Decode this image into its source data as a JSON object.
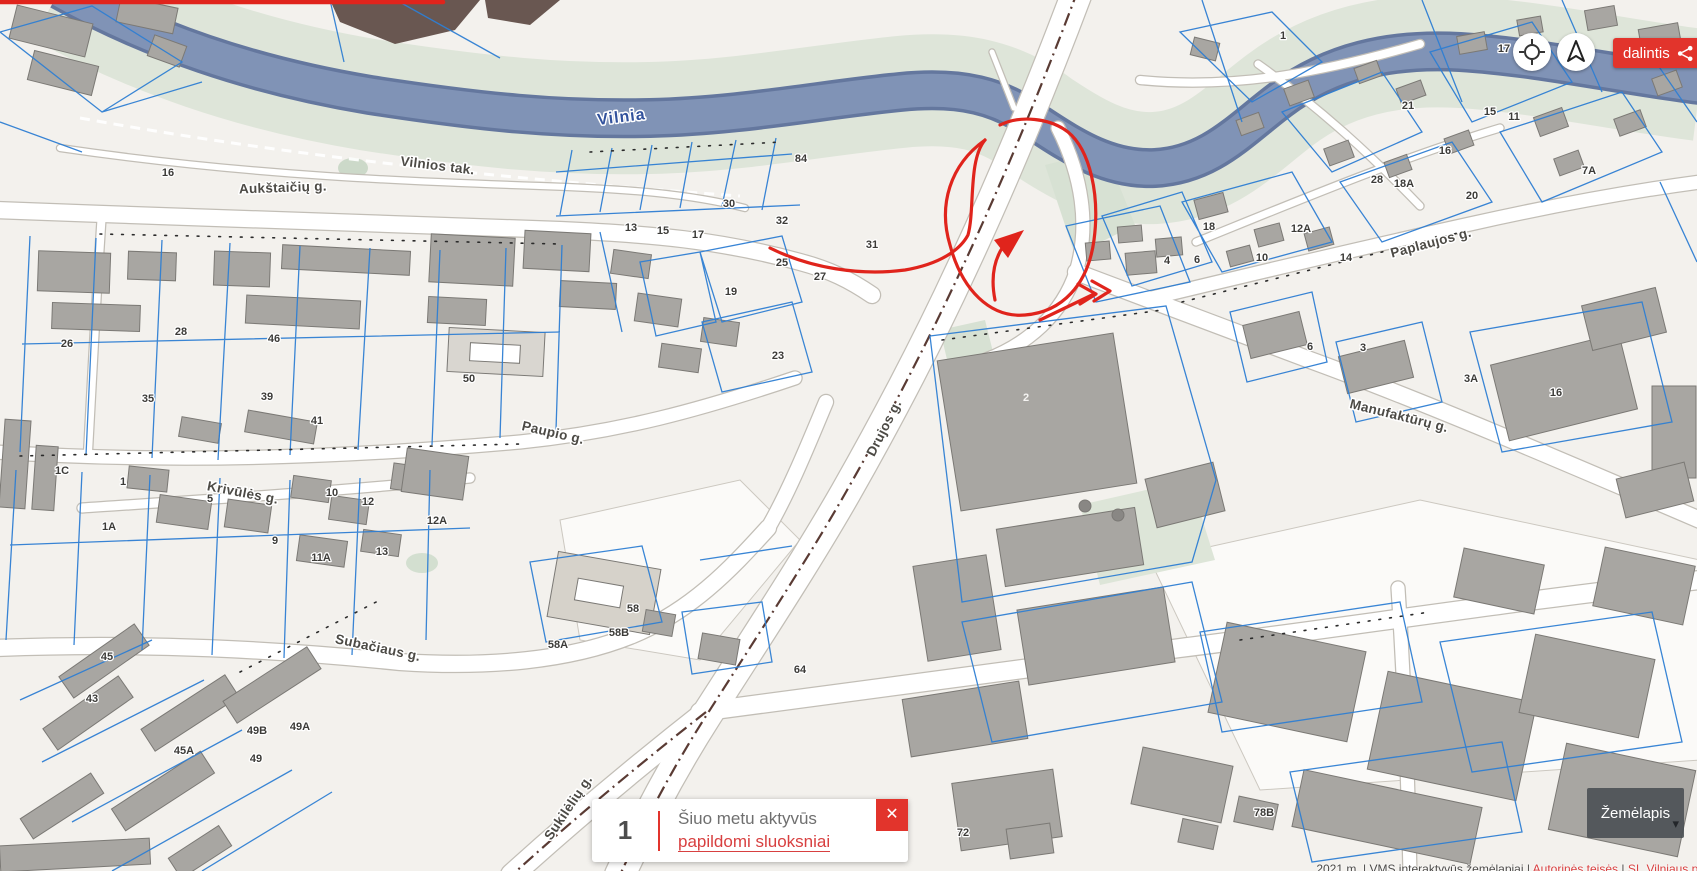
{
  "icons": {
    "close": "✕",
    "caret": "▾"
  },
  "controls": {
    "share_label": "dalintis"
  },
  "notification": {
    "count": "1",
    "message": "Šiuo metu aktyvūs",
    "link_label": "papildomi sluoksniai"
  },
  "basemap": {
    "label": "Žemėlapis"
  },
  "attribution": {
    "prefix": "2021 m. | VMS interaktyvūs žemėlapiai | ",
    "copyright_link": "Autorinės teisės",
    "separator": " | ",
    "publisher": "SĮ „Vilniaus planas“"
  },
  "colors": {
    "accent_red": "#e2342c",
    "link_red": "#d84040",
    "annotation_red": "#e0241c",
    "parcel_blue": "#2e7ed3",
    "river_blue": "#8093b6",
    "building_gray": "#a8a6a2",
    "basemap_bg": "rgba(72,77,82,0.88)"
  },
  "map": {
    "river_label": {
      "text": "Vilnia",
      "x": 622,
      "y": 122,
      "rotate": -7
    },
    "street_labels": [
      {
        "text": "Vilnios tak.",
        "x": 437,
        "y": 170,
        "rotate": 7
      },
      {
        "text": "Aukštaičių g.",
        "x": 283,
        "y": 192,
        "rotate": -2
      },
      {
        "text": "Paupio g.",
        "x": 552,
        "y": 437,
        "rotate": 13
      },
      {
        "text": "Krivūlės g.",
        "x": 242,
        "y": 497,
        "rotate": 11
      },
      {
        "text": "Subačiaus g.",
        "x": 377,
        "y": 652,
        "rotate": 12
      },
      {
        "text": "Drujos g.",
        "x": 888,
        "y": 430,
        "rotate": -63
      },
      {
        "text": "Paplaujos g.",
        "x": 1432,
        "y": 247,
        "rotate": -15
      },
      {
        "text": "Manufaktūrų g.",
        "x": 1398,
        "y": 420,
        "rotate": 14
      },
      {
        "text": "Sukilėlių g.",
        "x": 572,
        "y": 810,
        "rotate": -56
      }
    ],
    "parcel_numbers": [
      {
        "text": "16",
        "x": 168,
        "y": 176
      },
      {
        "text": "13",
        "x": 631,
        "y": 231
      },
      {
        "text": "15",
        "x": 663,
        "y": 234
      },
      {
        "text": "17",
        "x": 698,
        "y": 238
      },
      {
        "text": "30",
        "x": 729,
        "y": 207
      },
      {
        "text": "32",
        "x": 782,
        "y": 224
      },
      {
        "text": "84",
        "x": 801,
        "y": 162
      },
      {
        "text": "31",
        "x": 872,
        "y": 248
      },
      {
        "text": "25",
        "x": 782,
        "y": 266
      },
      {
        "text": "27",
        "x": 820,
        "y": 280
      },
      {
        "text": "19",
        "x": 731,
        "y": 295
      },
      {
        "text": "23",
        "x": 778,
        "y": 359
      },
      {
        "text": "50",
        "x": 469,
        "y": 382
      },
      {
        "text": "46",
        "x": 274,
        "y": 342
      },
      {
        "text": "28",
        "x": 181,
        "y": 335
      },
      {
        "text": "26",
        "x": 67,
        "y": 347
      },
      {
        "text": "35",
        "x": 148,
        "y": 402
      },
      {
        "text": "39",
        "x": 267,
        "y": 400
      },
      {
        "text": "41",
        "x": 317,
        "y": 424
      },
      {
        "text": "1C",
        "x": 62,
        "y": 474
      },
      {
        "text": "1",
        "x": 123,
        "y": 485
      },
      {
        "text": "1A",
        "x": 109,
        "y": 530
      },
      {
        "text": "5",
        "x": 210,
        "y": 502
      },
      {
        "text": "9",
        "x": 275,
        "y": 544
      },
      {
        "text": "10",
        "x": 332,
        "y": 496
      },
      {
        "text": "12",
        "x": 368,
        "y": 505
      },
      {
        "text": "12A",
        "x": 437,
        "y": 524
      },
      {
        "text": "11A",
        "x": 321,
        "y": 561
      },
      {
        "text": "13",
        "x": 382,
        "y": 555
      },
      {
        "text": "58",
        "x": 633,
        "y": 612
      },
      {
        "text": "58B",
        "x": 619,
        "y": 636
      },
      {
        "text": "58A",
        "x": 558,
        "y": 648
      },
      {
        "text": "64",
        "x": 800,
        "y": 673
      },
      {
        "text": "45",
        "x": 107,
        "y": 660
      },
      {
        "text": "43",
        "x": 92,
        "y": 702
      },
      {
        "text": "49B",
        "x": 257,
        "y": 734
      },
      {
        "text": "49A",
        "x": 300,
        "y": 730
      },
      {
        "text": "49",
        "x": 256,
        "y": 762
      },
      {
        "text": "45A",
        "x": 184,
        "y": 754
      },
      {
        "text": "2",
        "x": 1026,
        "y": 401,
        "light": true
      },
      {
        "text": "4",
        "x": 1167,
        "y": 264
      },
      {
        "text": "6",
        "x": 1197,
        "y": 263
      },
      {
        "text": "3",
        "x": 1363,
        "y": 351
      },
      {
        "text": "3A",
        "x": 1471,
        "y": 382
      },
      {
        "text": "16",
        "x": 1556,
        "y": 396
      },
      {
        "text": "6",
        "x": 1310,
        "y": 350
      },
      {
        "text": "18",
        "x": 1209,
        "y": 230
      },
      {
        "text": "12A",
        "x": 1301,
        "y": 232
      },
      {
        "text": "10",
        "x": 1262,
        "y": 261
      },
      {
        "text": "14",
        "x": 1346,
        "y": 261
      },
      {
        "text": "28",
        "x": 1377,
        "y": 183
      },
      {
        "text": "18A",
        "x": 1404,
        "y": 187
      },
      {
        "text": "20",
        "x": 1472,
        "y": 199
      },
      {
        "text": "21",
        "x": 1408,
        "y": 109
      },
      {
        "text": "15",
        "x": 1490,
        "y": 115
      },
      {
        "text": "11",
        "x": 1514,
        "y": 120
      },
      {
        "text": "7A",
        "x": 1589,
        "y": 174
      },
      {
        "text": "17",
        "x": 1504,
        "y": 52
      },
      {
        "text": "1",
        "x": 1283,
        "y": 39
      },
      {
        "text": "16",
        "x": 1445,
        "y": 154
      },
      {
        "text": "78B",
        "x": 1264,
        "y": 816
      },
      {
        "text": "72",
        "x": 963,
        "y": 836
      }
    ]
  }
}
